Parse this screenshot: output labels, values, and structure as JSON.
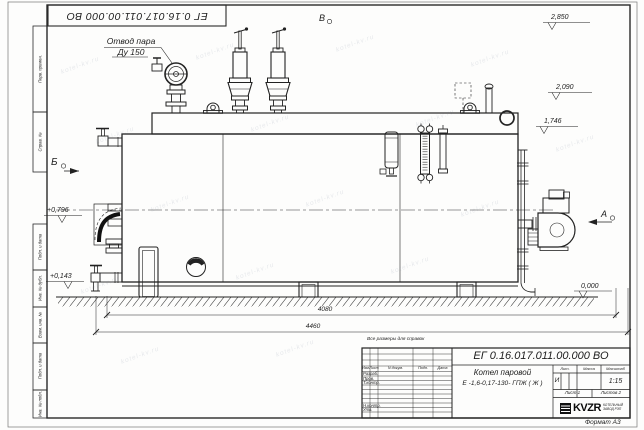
{
  "frame": {
    "doc_number_top": "ЕГ 0.16.017.011.00.000  ВО",
    "margin_labels": [
      "Перв. примен.",
      "Справ. №",
      "Подп. и дата",
      "Инв. № дубл.",
      "Взам. инв. №",
      "Подп. и дата",
      "Инв. № подл."
    ],
    "format_note": "Формат А3"
  },
  "drawing": {
    "steam_label_1": "Отвод пара",
    "steam_label_2": "Ду 150",
    "views": {
      "a": "А",
      "b": "Б",
      "v": "В"
    },
    "elevations": {
      "top": "2,850",
      "mid": "2,090",
      "band": "1,746",
      "left_upper": "+0,796",
      "left_lower": "+0,143",
      "ground": "0,000"
    },
    "dimensions": {
      "inner": "4080",
      "outer": "4460"
    },
    "note": "Все размеры для справок"
  },
  "title_block": {
    "doc_number": "ЕГ 0.16.017.011.00.000  ВО",
    "product_name": "Котел паровой",
    "product_code": "Е -1,6-0,17-130- ГПЖ ( Ж )",
    "columns": [
      "Изм.",
      "Лист",
      "N докум.",
      "Подп.",
      "Дата"
    ],
    "rows": [
      "Разраб.",
      "Пров.",
      "Т.контр.",
      "Н.контр.",
      "Утв."
    ],
    "lit_header": "Лит.",
    "mass_header": "Масса",
    "scale_header": "Масштаб",
    "litera": "И",
    "scale": "1:15",
    "sheet": "Лист 1",
    "sheets": "Листов 2"
  },
  "logo": {
    "name": "KVZR",
    "sub1": "КОТЕЛЬНЫЙ",
    "sub2": "ЗАВОД РЭП"
  },
  "watermark": {
    "text": "kotel-kv.ru"
  }
}
